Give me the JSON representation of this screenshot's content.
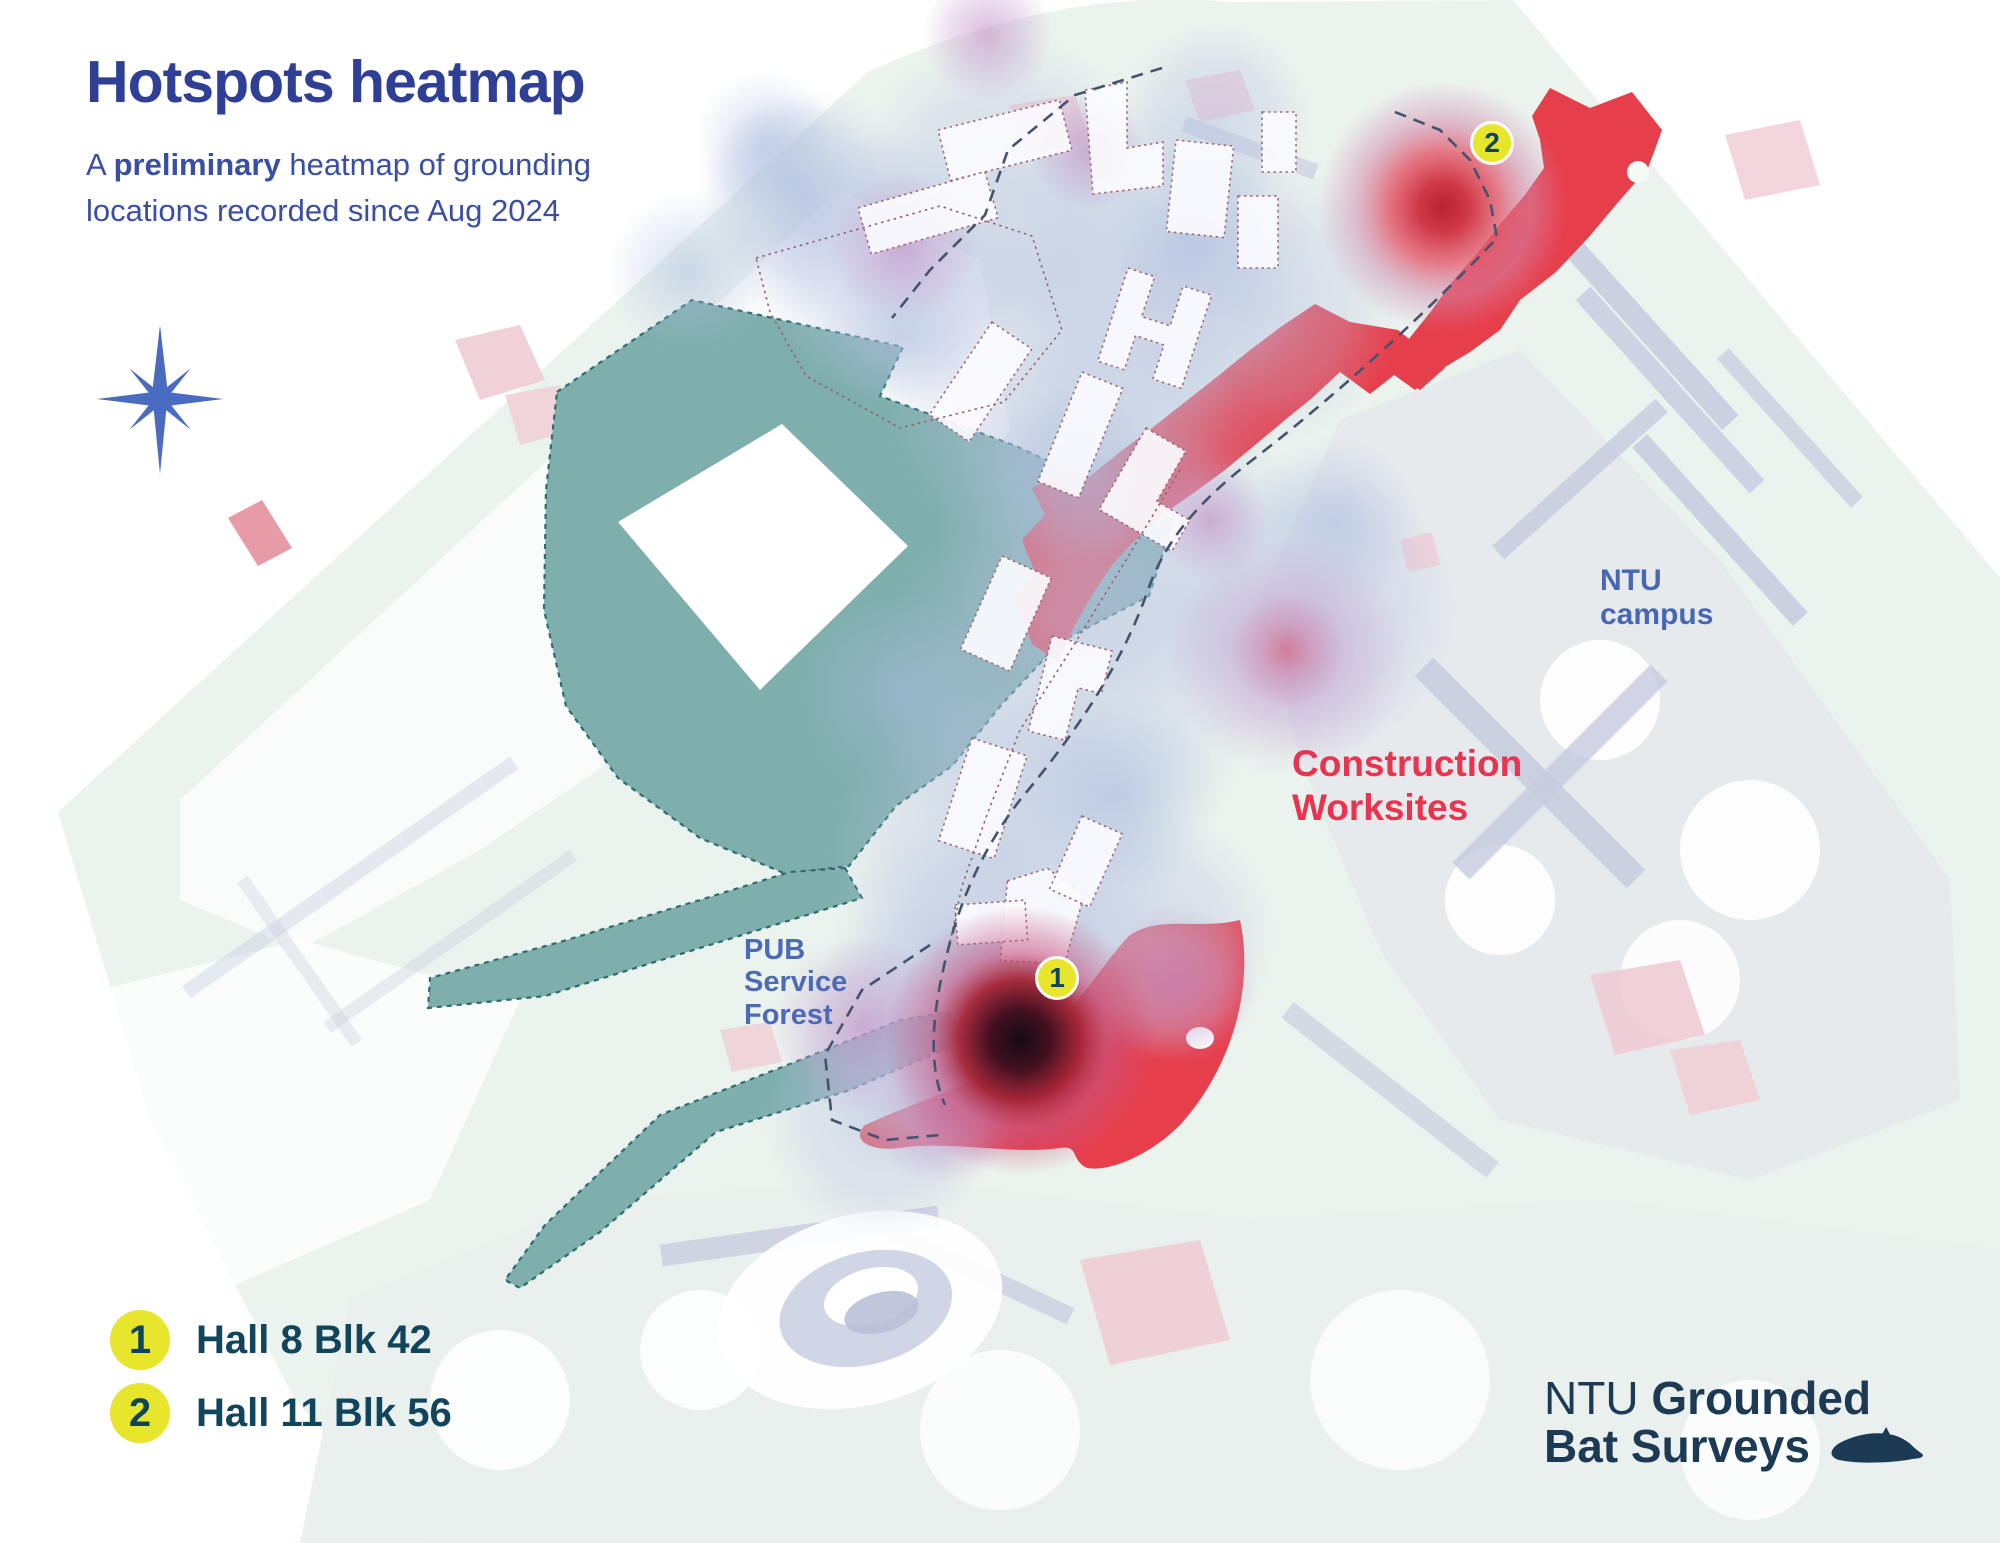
{
  "header": {
    "title": "Hotspots heatmap",
    "subtitle_a": "A ",
    "subtitle_bold": "preliminary",
    "subtitle_rest": " heatmap of grounding",
    "subtitle_line2": "locations recorded since Aug 2024"
  },
  "map_labels": {
    "forest_line1": "PUB",
    "forest_line2": "Service",
    "forest_line3": "Forest",
    "campus_line1": "NTU",
    "campus_line2": "campus",
    "worksites_line1": "Construction",
    "worksites_line2": "Worksites"
  },
  "markers": [
    {
      "number": "1"
    },
    {
      "number": "2"
    }
  ],
  "legend": {
    "items": [
      {
        "number": "1",
        "label": "Hall 8 Blk 42"
      },
      {
        "number": "2",
        "label": "Hall 11 Blk 56"
      }
    ]
  },
  "logo": {
    "org": "NTU",
    "title_bold": "Grounded",
    "title_line2": "Bat Surveys"
  },
  "colors": {
    "title_blue": "#2f3f96",
    "subtitle_blue": "#3a4fa4",
    "map_label_blue": "#4a68b8",
    "worksite_red": "#e73e4b",
    "worksite_label_red": "#e8344e",
    "forest_teal": "#7fafad",
    "forest_border_teal": "#2e6b70",
    "marker_yellow": "#e7e52c",
    "marker_number_navy": "#0f455b",
    "legend_text_navy": "#11455c",
    "logo_navy": "#1d3a55",
    "heat_lavender": "#b9c3e2",
    "heat_purple": "#c490c5",
    "heat_red": "#cf2e3d",
    "heat_dark_core": "#150a10",
    "base_green": "#ebf3ee",
    "built_gray": "#e6e7ec",
    "road_lavender": "#c5cade",
    "patch_pink": "#f0ccd4"
  }
}
